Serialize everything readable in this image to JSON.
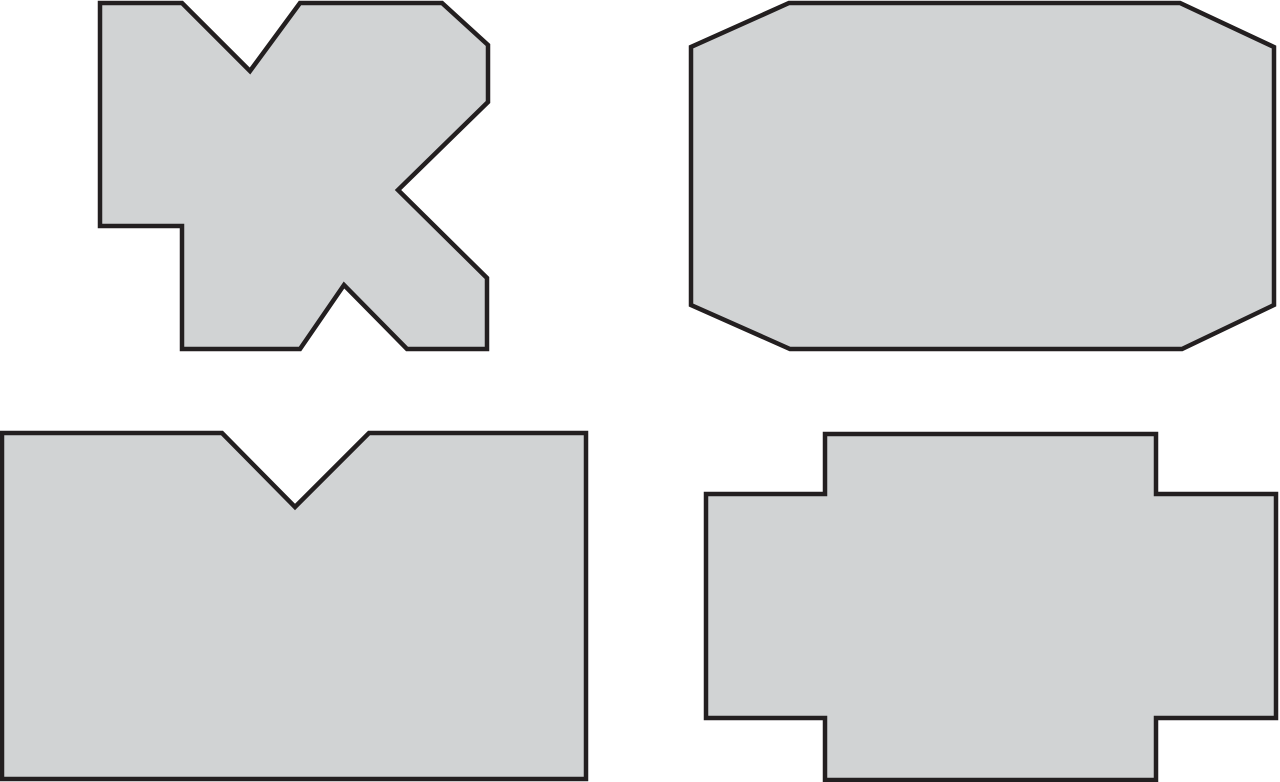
{
  "figure": {
    "description": "Four gray outlined polygon cross-section shapes on a white background, arranged in a 2x2 grid",
    "background_color": "#ffffff",
    "shape_fill_color": "#d1d3d4",
    "shape_stroke_color": "#231f20",
    "stroke_width": 4.5,
    "canvas": {
      "width": 1280,
      "height": 782
    },
    "shapes": [
      {
        "name": "x-notched-block",
        "position": "top-left",
        "points": "100,3 182,3 250,71 300,3 442,3 488,45 488,102 398,190 487,278 487,349 407,349 344,285 300,349 182,349 182,226 100,226"
      },
      {
        "name": "chamfered-octagon-block",
        "position": "top-right",
        "points": "789,3 1180,3 1274,47 1274,305 1182,349 790,349 691,305 691,47"
      },
      {
        "name": "v-notched-block",
        "position": "bottom-left",
        "points": "2,433 222,433 295,507 369,433 586,433 586,779 2,779"
      },
      {
        "name": "stepped-cross-block",
        "position": "bottom-right",
        "points": "825,434 1156,434 1156,494 1276,494 1276,718 1156,718 1156,780 825,780 825,718 706,718 706,494 825,494"
      }
    ]
  }
}
